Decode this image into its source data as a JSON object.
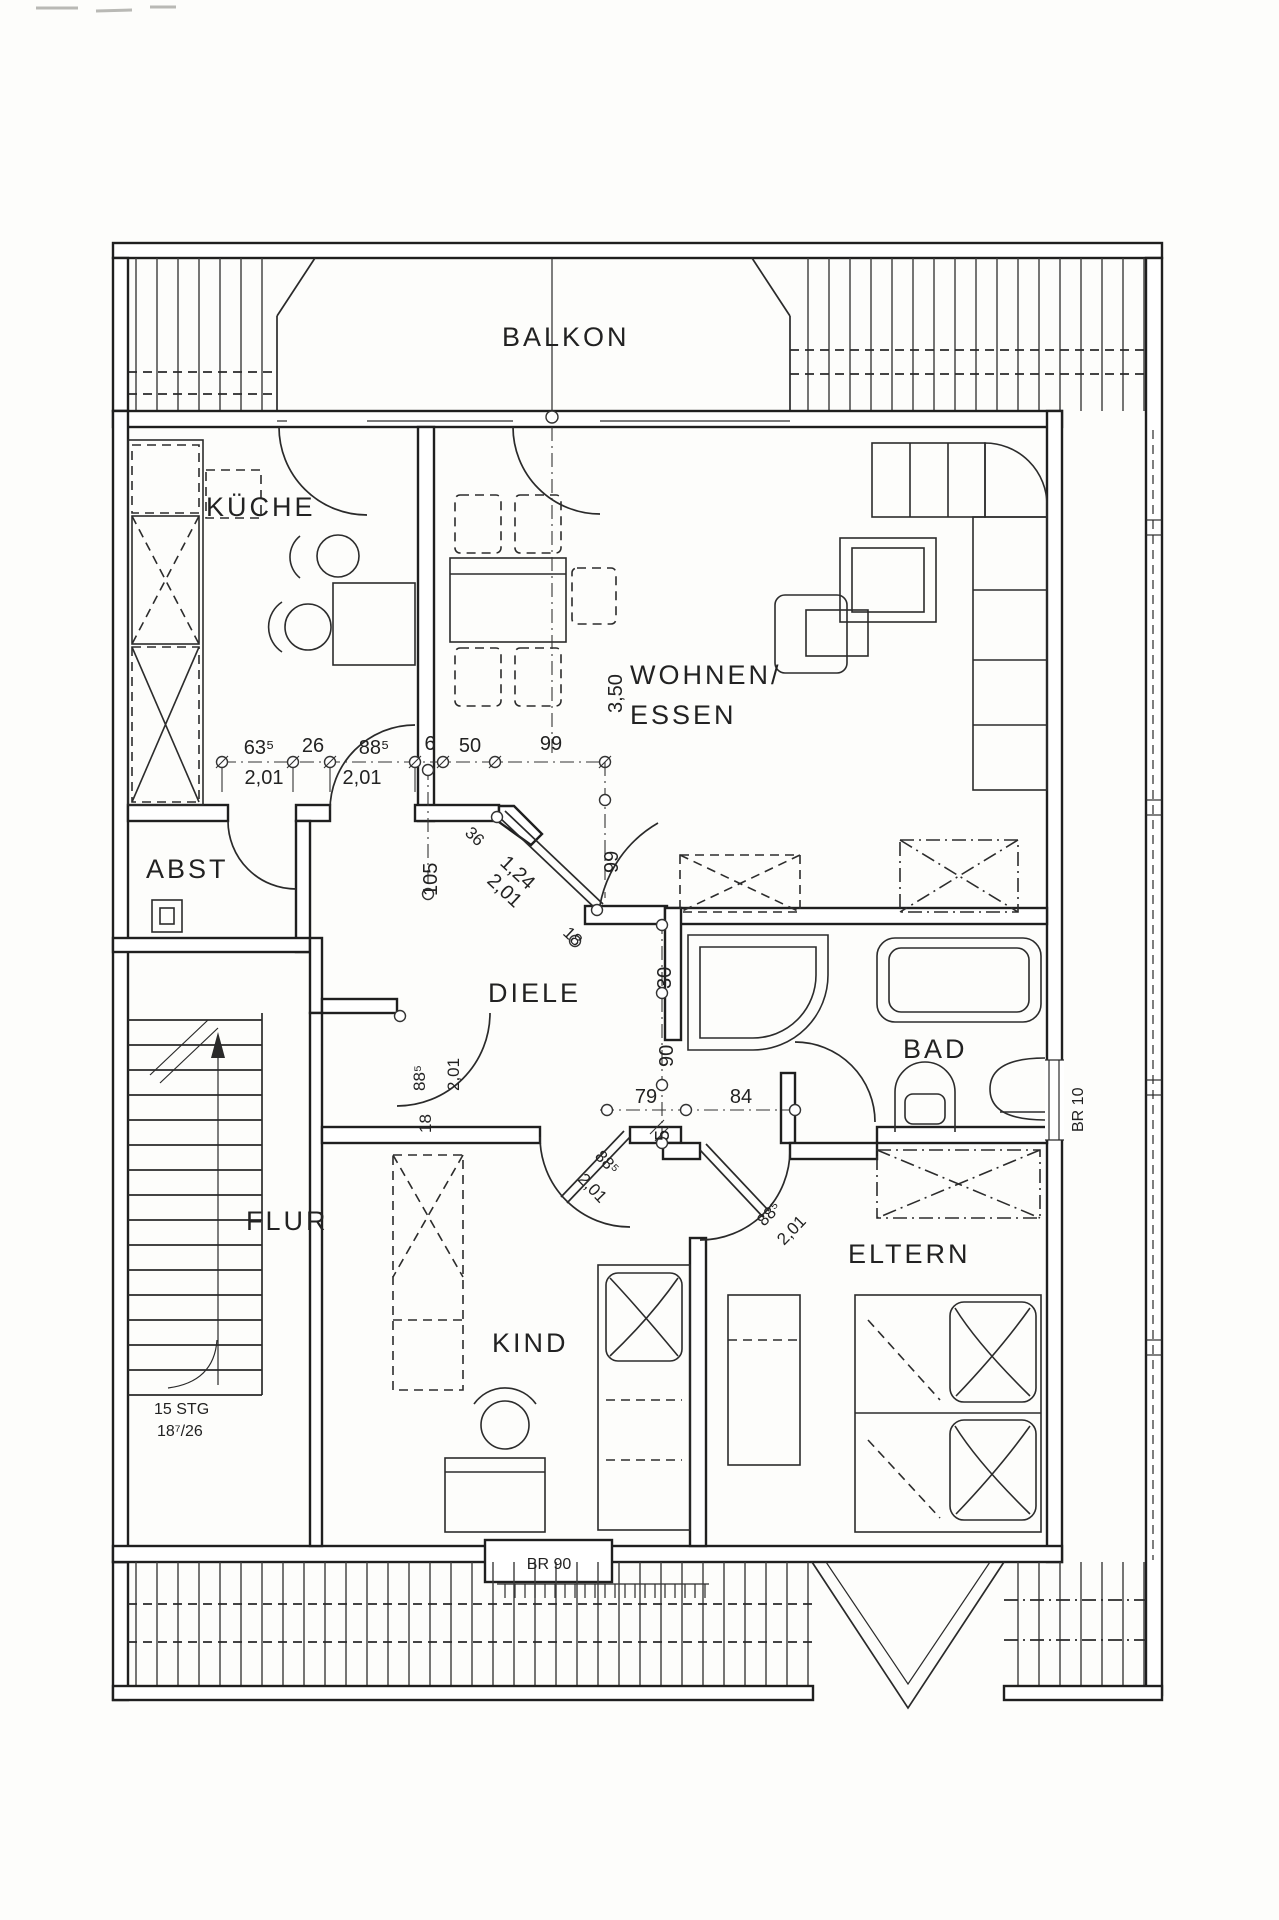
{
  "rooms": {
    "balkon": {
      "label": "BALKON"
    },
    "kueche": {
      "label": "KÜCHE"
    },
    "wohnen": {
      "label_line1": "WOHNEN/",
      "label_line2": "ESSEN"
    },
    "abst": {
      "label": "ABST"
    },
    "diele": {
      "label": "DIELE"
    },
    "bad": {
      "label": "BAD"
    },
    "flur": {
      "label": "FLUR"
    },
    "kind": {
      "label": "KIND"
    },
    "eltern": {
      "label": "ELTERN"
    }
  },
  "dims": {
    "chain_top": [
      "63⁵",
      "26",
      "88⁵",
      "6",
      "50",
      "99"
    ],
    "chain_top_doors": [
      "2,01",
      "2,01"
    ],
    "living_depth": "3,50",
    "living_door_height": "99",
    "hall_width": "105",
    "diag_door": {
      "offset": "36",
      "width": "1,24",
      "height": "2,01",
      "end": "18"
    },
    "right_chain": [
      "30",
      "90",
      "5"
    ],
    "bottom_chain": [
      "79",
      "84"
    ],
    "flur_door": {
      "width": "88⁵",
      "height": "2,01",
      "offset": "18"
    },
    "kind_door": {
      "width": "88⁵",
      "height": "2,01"
    },
    "eltern_door": {
      "width": "88⁵",
      "height": "2,01"
    }
  },
  "stairs": {
    "count": "15 STG",
    "step": "18⁷/26"
  },
  "windows": {
    "bottom_parapet": "BR 90",
    "right_parapet": "BR 10"
  }
}
